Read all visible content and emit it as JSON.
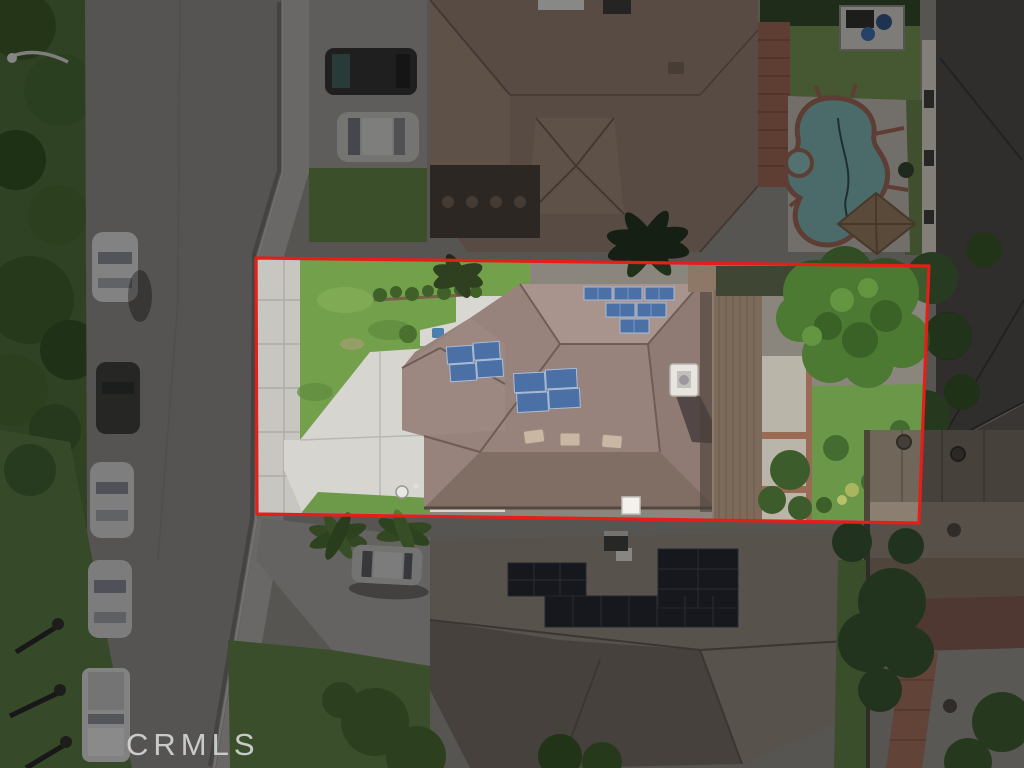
{
  "image_type": "aerial-drone-photograph of residential parcel",
  "watermark": {
    "label": "CRMLS"
  },
  "boundary": {
    "label": "subject-property-outline",
    "points": "256,258 929,266 919,523 257,514",
    "color": "#e41e18",
    "width": 3.2
  },
  "palette": {
    "boundary_red": "#e41e18",
    "asphalt": "#87857f",
    "concrete_dim": "#a6a59e",
    "driveway": "#d6d5cf",
    "subject_lawn": "#72a04b",
    "backyard_lawn": "#6b9748",
    "tree_green": "#4c7a33",
    "pool_water": "#76aaa5",
    "pool_coping": "#93604e",
    "solar_blue": "#4a70a6",
    "solar_dark": "#23242a",
    "subject_roof": "#97837b",
    "subject_roof_light": "#a8948c",
    "subject_roof_shade": "#806e65",
    "upper_roof_tan": "#8b7668",
    "bottom_roof": "#8a8175",
    "right_roof_dark": "#4b4743",
    "rust_roof": "#7e6c58",
    "overlay_dim": "rgba(6,6,10,0.38)"
  },
  "scene": {
    "subject_property": {
      "features": [
        "hip-roof house with gray-brown tile roof",
        "pyramid solar array (3+2+1 blue panels) on rear roof face",
        "two 2x2 blue solar arrays on front roof faces",
        "white rooftop AC unit with shadow",
        "three roof vents",
        "white chimney cap",
        "front lawn with shrub planter and paver patio",
        "white concrete driveway",
        "sidewalk strip along street",
        "satellite dish",
        "rear covered patio (long brown cover)",
        "rear concrete patio with brick accent bands",
        "large backyard shade tree",
        "rear lawn with shrubs"
      ]
    },
    "street_west": {
      "features": [
        "asphalt street running along left side",
        "curb and gutter",
        "sidewalk and grass parkway",
        "street trees",
        "street lamps"
      ],
      "parked_vehicles": [
        "white sedan",
        "dark car in tree shadow",
        "white sedan",
        "white sedan",
        "white pickup truck"
      ]
    },
    "north_neighbor": {
      "features": [
        "large tan Spanish-tile roof house",
        "dark entry porch",
        "skylight",
        "driveway with dark SUV and silver sedan",
        "kidney-shaped swimming pool",
        "red-brown pool coping and deck joints",
        "spa",
        "tan gazebo roof",
        "pool equipment enclosure",
        "red tile patio strip"
      ]
    },
    "east_neighbor": {
      "features": [
        "two-story house with dark charcoal shingle roof",
        "cream wall with windows",
        "trees along fence line"
      ]
    },
    "south_neighbor": {
      "features": [
        "gray-brown roof house",
        "two dark solar arrays plus long panel row",
        "chimney",
        "driveway",
        "palm trees",
        "silver sedan parked at curb apron",
        "front lawn with trees"
      ]
    },
    "southeast_structures": {
      "features": [
        "rust-brown metal roofs with round vents",
        "red-brown awning",
        "brick walkway",
        "large dark tree"
      ]
    }
  }
}
